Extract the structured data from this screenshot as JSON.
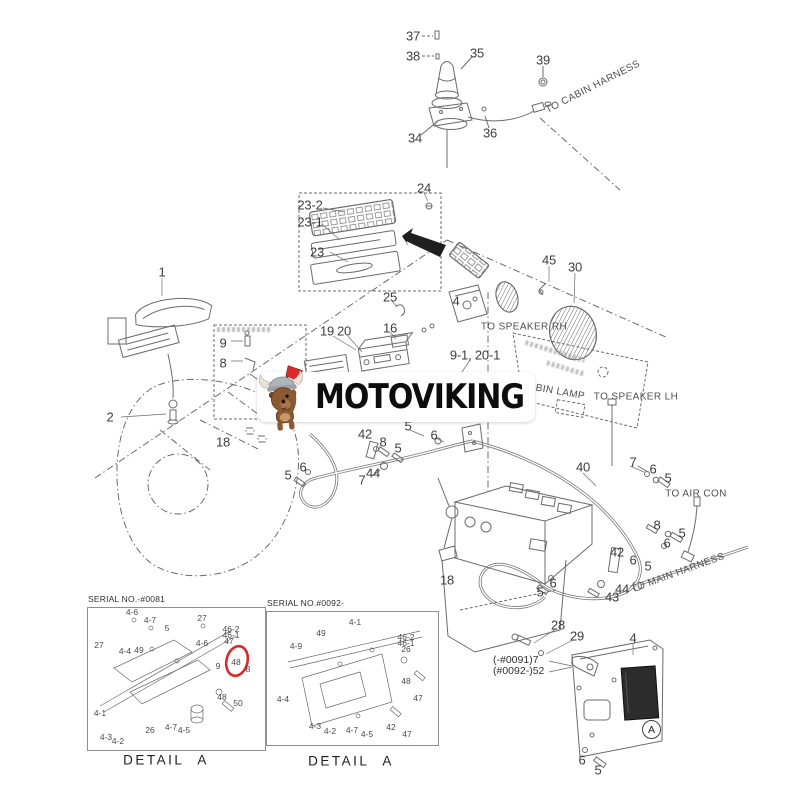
{
  "page": {
    "background": "#ffffff"
  },
  "watermark": {
    "brand": "MOTOVIKING",
    "logo_icon": "viking-dog-axe-logo"
  },
  "harness_texts": {
    "to_cabin_harness": "TO CABIN HARNESS",
    "to_speaker_rh": "TO SPEAKER RH",
    "to_speaker_lh": "TO SPEAKER LH",
    "to_air_con": "TO AIR CON",
    "to_main_harness": "TO MAIN HARNESS",
    "cabin_lamp": "CABIN LAMP"
  },
  "marker": {
    "letter": "A"
  },
  "serial_notes": [
    {
      "t": "(-#0091)7",
      "x": 493,
      "y": 660
    },
    {
      "t": "(#0092-)52",
      "x": 493,
      "y": 671
    }
  ],
  "callouts": [
    {
      "t": "37",
      "x": 413,
      "y": 36
    },
    {
      "t": "38",
      "x": 413,
      "y": 56
    },
    {
      "t": "35",
      "x": 477,
      "y": 53
    },
    {
      "t": "39",
      "x": 543,
      "y": 60
    },
    {
      "t": "34",
      "x": 415,
      "y": 138
    },
    {
      "t": "36",
      "x": 490,
      "y": 133
    },
    {
      "t": "24",
      "x": 424,
      "y": 188
    },
    {
      "t": "23-2",
      "x": 310,
      "y": 205
    },
    {
      "t": "23-1",
      "x": 310,
      "y": 222
    },
    {
      "t": "23",
      "x": 317,
      "y": 252
    },
    {
      "t": "25",
      "x": 390,
      "y": 297
    },
    {
      "t": "4",
      "x": 456,
      "y": 301
    },
    {
      "t": "45",
      "x": 549,
      "y": 260
    },
    {
      "t": "30",
      "x": 575,
      "y": 267
    },
    {
      "t": "19",
      "x": 327,
      "y": 331
    },
    {
      "t": "20",
      "x": 344,
      "y": 331
    },
    {
      "t": "16",
      "x": 390,
      "y": 328
    },
    {
      "t": "9-1, 20-1",
      "x": 475,
      "y": 355
    },
    {
      "t": "1",
      "x": 162,
      "y": 272
    },
    {
      "t": "2",
      "x": 110,
      "y": 417
    },
    {
      "t": "9",
      "x": 223,
      "y": 343
    },
    {
      "t": "8",
      "x": 223,
      "y": 363
    },
    {
      "t": "18",
      "x": 223,
      "y": 442
    },
    {
      "t": "42",
      "x": 365,
      "y": 434
    },
    {
      "t": "8",
      "x": 383,
      "y": 442
    },
    {
      "t": "5",
      "x": 398,
      "y": 448
    },
    {
      "t": "44",
      "x": 373,
      "y": 473
    },
    {
      "t": "7",
      "x": 362,
      "y": 480
    },
    {
      "t": "6",
      "x": 303,
      "y": 467
    },
    {
      "t": "5",
      "x": 288,
      "y": 475
    },
    {
      "t": "5",
      "x": 408,
      "y": 426
    },
    {
      "t": "6",
      "x": 434,
      "y": 435
    },
    {
      "t": "40",
      "x": 583,
      "y": 467
    },
    {
      "t": "7",
      "x": 633,
      "y": 462
    },
    {
      "t": "6",
      "x": 653,
      "y": 469
    },
    {
      "t": "5",
      "x": 668,
      "y": 478
    },
    {
      "t": "8",
      "x": 657,
      "y": 525
    },
    {
      "t": "5",
      "x": 682,
      "y": 533
    },
    {
      "t": "6",
      "x": 667,
      "y": 543
    },
    {
      "t": "42",
      "x": 617,
      "y": 552
    },
    {
      "t": "6",
      "x": 633,
      "y": 560
    },
    {
      "t": "5",
      "x": 648,
      "y": 566
    },
    {
      "t": "44",
      "x": 622,
      "y": 589
    },
    {
      "t": "43",
      "x": 612,
      "y": 597
    },
    {
      "t": "6",
      "x": 553,
      "y": 583
    },
    {
      "t": "5",
      "x": 540,
      "y": 592
    },
    {
      "t": "18",
      "x": 447,
      "y": 580
    },
    {
      "t": "28",
      "x": 558,
      "y": 625
    },
    {
      "t": "29",
      "x": 577,
      "y": 636
    },
    {
      "t": "4",
      "x": 633,
      "y": 638
    },
    {
      "t": "6",
      "x": 582,
      "y": 760
    },
    {
      "t": "5",
      "x": 598,
      "y": 770
    }
  ],
  "detail_boxes": [
    {
      "header": "SERIAL NO.-#0081",
      "caption": "DETAIL A",
      "highlight_color": "#d92b2b",
      "labels": [
        {
          "t": "4-6",
          "x": 132,
          "y": 612
        },
        {
          "t": "4-7",
          "x": 150,
          "y": 620
        },
        {
          "t": "5",
          "x": 167,
          "y": 628
        },
        {
          "t": "27",
          "x": 202,
          "y": 618
        },
        {
          "t": "27",
          "x": 99,
          "y": 645
        },
        {
          "t": "4-4",
          "x": 125,
          "y": 651
        },
        {
          "t": "49",
          "x": 139,
          "y": 650
        },
        {
          "t": "4-6",
          "x": 202,
          "y": 643
        },
        {
          "t": "46-2",
          "x": 231,
          "y": 629
        },
        {
          "t": "46-1",
          "x": 231,
          "y": 635
        },
        {
          "t": "47",
          "x": 229,
          "y": 641
        },
        {
          "t": "48",
          "x": 236,
          "y": 662
        },
        {
          "t": "9",
          "x": 218,
          "y": 666
        },
        {
          "t": "8",
          "x": 248,
          "y": 669
        },
        {
          "t": "48",
          "x": 222,
          "y": 697
        },
        {
          "t": "50",
          "x": 238,
          "y": 703
        },
        {
          "t": "4-1",
          "x": 100,
          "y": 713
        },
        {
          "t": "26",
          "x": 150,
          "y": 730
        },
        {
          "t": "4-7",
          "x": 171,
          "y": 727
        },
        {
          "t": "4-5",
          "x": 184,
          "y": 730
        },
        {
          "t": "4-3",
          "x": 106,
          "y": 737
        },
        {
          "t": "4-2",
          "x": 118,
          "y": 741
        }
      ]
    },
    {
      "header": "SERIAL NO.#0092-",
      "caption": "DETAIL A",
      "labels": [
        {
          "t": "4-1",
          "x": 355,
          "y": 622
        },
        {
          "t": "49",
          "x": 321,
          "y": 633
        },
        {
          "t": "4-9",
          "x": 296,
          "y": 646
        },
        {
          "t": "46-2",
          "x": 406,
          "y": 637
        },
        {
          "t": "46-1",
          "x": 406,
          "y": 643
        },
        {
          "t": "26",
          "x": 406,
          "y": 649
        },
        {
          "t": "48",
          "x": 406,
          "y": 681
        },
        {
          "t": "47",
          "x": 418,
          "y": 698
        },
        {
          "t": "4-4",
          "x": 283,
          "y": 699
        },
        {
          "t": "4-3",
          "x": 315,
          "y": 726
        },
        {
          "t": "4-2",
          "x": 330,
          "y": 731
        },
        {
          "t": "4-7",
          "x": 352,
          "y": 730
        },
        {
          "t": "4-5",
          "x": 367,
          "y": 734
        },
        {
          "t": "42",
          "x": 391,
          "y": 727
        },
        {
          "t": "47",
          "x": 407,
          "y": 734
        }
      ]
    }
  ],
  "colors": {
    "accent_red": "#d92b2b",
    "line": "#6b6b6b",
    "label_text": "#3d3d3d",
    "brand_text": "#0d0d0d",
    "dog_brown": "#8a5a33",
    "helmet_gray": "#9aa0a6",
    "band_bg": "#ffffff"
  }
}
